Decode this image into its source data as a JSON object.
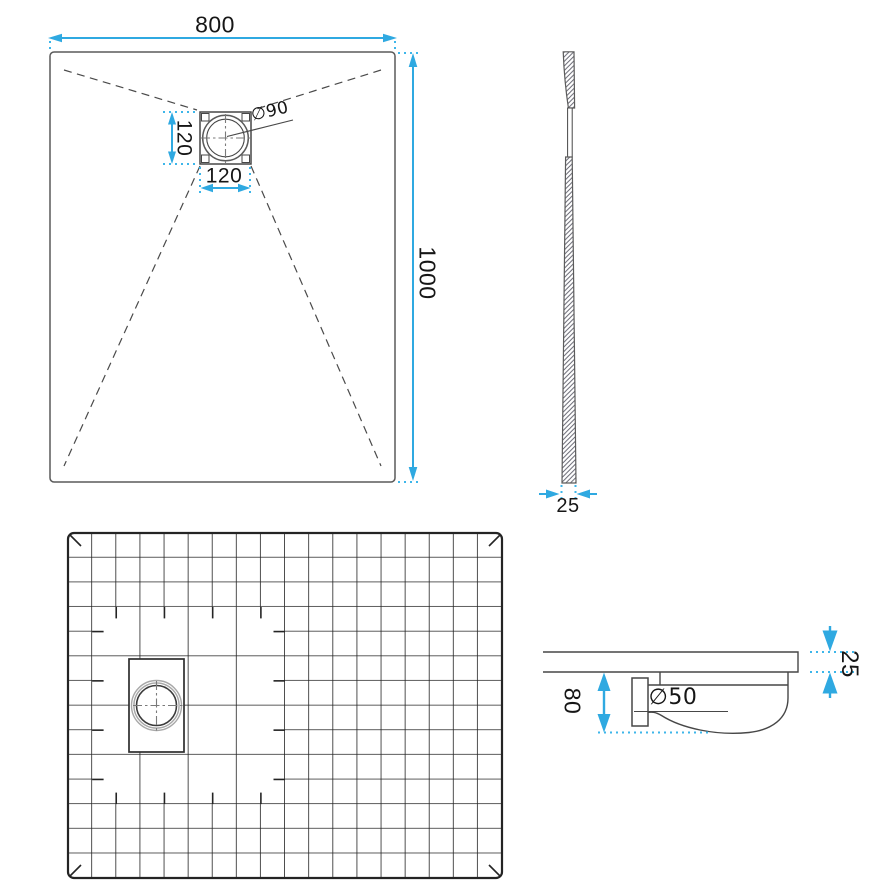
{
  "drawing": {
    "subject": "shower-tray-technical-drawing",
    "colors": {
      "accent": "#2fa9e1",
      "line": "#474747",
      "grid": "#242424"
    }
  },
  "views": {
    "top": {
      "width": "800",
      "length": "1000",
      "drain_width": "120",
      "drain_depth": "120",
      "drain_diameter": "∅90"
    },
    "side": {
      "thickness": "25"
    },
    "detail": {
      "thickness": "25",
      "drain_height": "80",
      "pipe_diameter": "∅50"
    }
  }
}
